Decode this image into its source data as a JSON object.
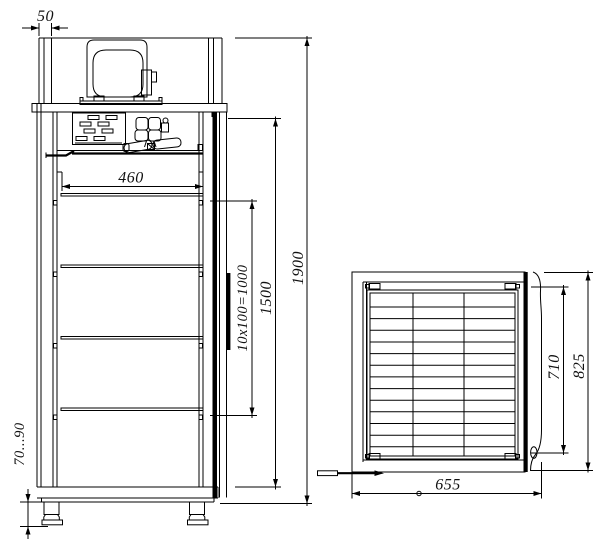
{
  "drawing": {
    "background_color": "#ffffff",
    "line_color": "#000000",
    "front_view": {
      "dim_post_width": "50",
      "dim_inner_width": "460",
      "dim_shelf_pitch": "10x100=1000",
      "dim_interior_height": "1500",
      "dim_overall_height": "1900",
      "dim_leg_height": "70...90"
    },
    "plan_view": {
      "dim_interior_depth": "710",
      "dim_overall_depth": "825",
      "dim_overall_width": "655"
    }
  }
}
